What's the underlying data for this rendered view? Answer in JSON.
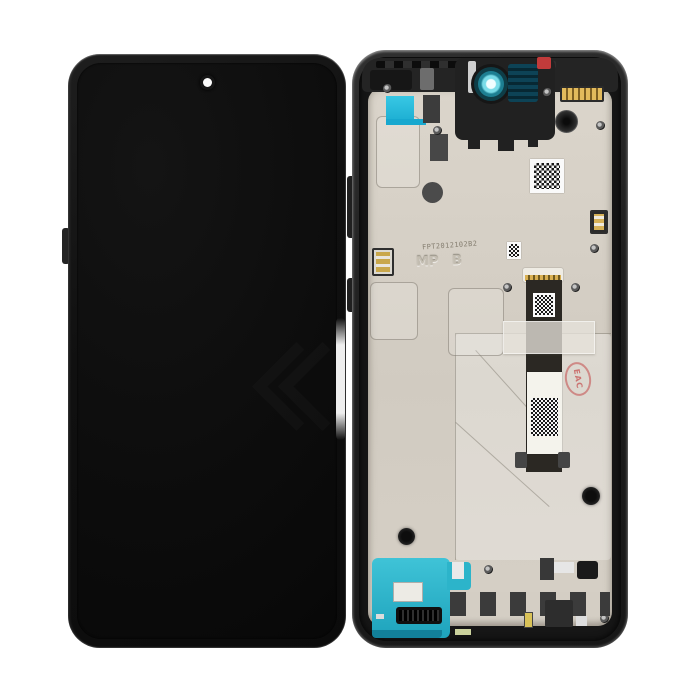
{
  "photo": {
    "type": "product-photo",
    "subject": "Smartphone LCD display assembly with mid-frame, front and rear views",
    "background": "#ffffff"
  },
  "front": {
    "screen_color": "#0d0d0d",
    "camera": "center punch-hole"
  },
  "back": {
    "flex_code": "FPT2012102B2",
    "frame_marking": "MP B",
    "stamp_text": "EAC",
    "colors": {
      "plate": "#d6d0c6",
      "tape_cyan": "#2bc0de",
      "speaker_teal": "#2fb7cb",
      "camera_teal": "#2aa7bd",
      "stamp_red": "#c34848",
      "connector_gold": "#d7b258",
      "frame": "#222222"
    }
  }
}
